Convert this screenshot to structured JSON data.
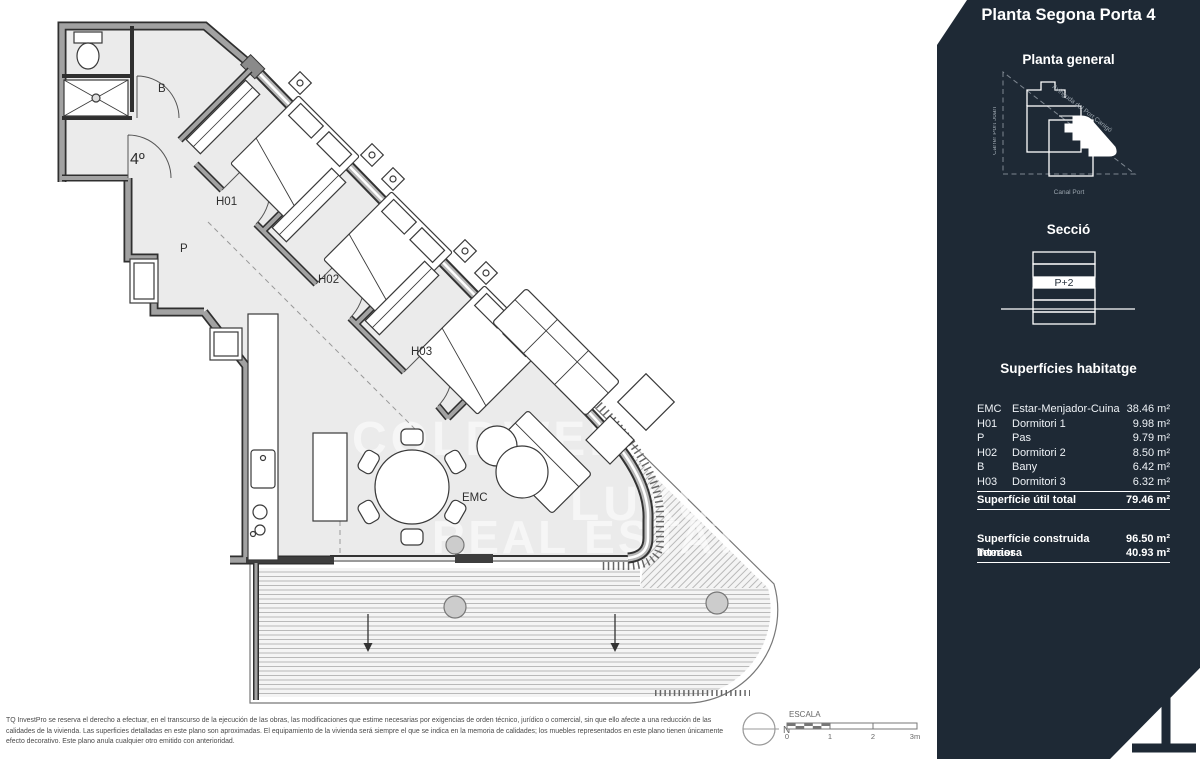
{
  "sidebar": {
    "title": "Planta Segona Porta 4",
    "site_plan": {
      "heading": "Planta general",
      "street_left": "Carrer Port Joan",
      "street_diagonal": "Avinguda del Port Canigó",
      "street_bottom": "Canal Port"
    },
    "section": {
      "heading": "Secció",
      "floor_label": "P+2"
    },
    "areas": {
      "heading": "Superfícies habitatge",
      "rows": [
        {
          "code": "EMC",
          "name": "Estar-Menjador-Cuina",
          "value": "38.46 m²"
        },
        {
          "code": "H01",
          "name": "Dormitori 1",
          "value": "9.98 m²"
        },
        {
          "code": "P",
          "name": "Pas",
          "value": "9.79 m²"
        },
        {
          "code": "H02",
          "name": "Dormitori 2",
          "value": "8.50 m²"
        },
        {
          "code": "B",
          "name": "Bany",
          "value": "6.42 m²"
        },
        {
          "code": "H03",
          "name": "Dormitori 3",
          "value": "6.32 m²"
        }
      ],
      "total_label": "Superfície útil total",
      "total_value": "79.46 m²",
      "built_label": "Superfície construida interior",
      "built_value": "96.50 m²",
      "terrace_label": "Terrassa",
      "terrace_value": "40.93 m²"
    }
  },
  "plan": {
    "unit_label": "4º",
    "rooms": {
      "bany": "B",
      "h01": "H01",
      "pas": "P",
      "h02": "H02",
      "h03": "H03",
      "emc": "EMC"
    }
  },
  "watermark": {
    "line1": "COLDWELL",
    "line2": "LUXURY",
    "line3": "REAL ESTATE"
  },
  "footer": {
    "disclaimer": "TQ InvestPro se reserva el derecho a efectuar, en el transcurso de la ejecución de las obras, las modificaciones que estime necesarias por exigencias de orden técnico, jurídico o comercial, sin que ello afecte a una reducción de las calidades de la vivienda. Las superficies detalladas en este plano son aproximadas. El equipamiento de la vivienda será siempre el que se indica en la memoria de calidades; los muebles representados en este plano tienen únicamente efecto decorativo. Este plano anula cualquier otro emitido con anterioridad.",
    "scale": {
      "label": "ESCALA",
      "north": "N",
      "ticks": [
        "0",
        "1",
        "2",
        "3m"
      ]
    }
  },
  "colors": {
    "sidebar_bg": "#1e2935",
    "wall_gray": "#9a9a9a",
    "interior_fill": "#ebebeb",
    "deck_line": "#b3b3b3"
  }
}
